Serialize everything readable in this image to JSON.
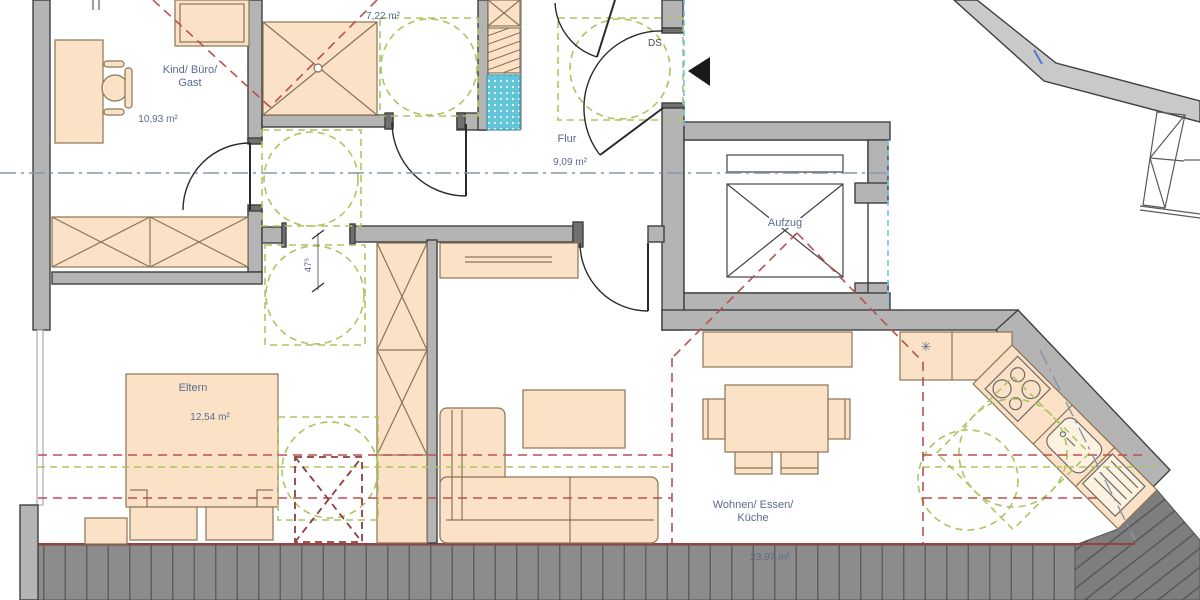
{
  "title": "Apartment floor plan (attic storey)",
  "texts": {
    "kind_line1": "Kind/ Büro/",
    "kind_line2": "Gast",
    "kind_area": "10,93 m²",
    "bath_area": "7,22 m²",
    "flur_name": "Flur",
    "flur_area": "9,09 m²",
    "ds": "DS",
    "aufzug": "Aufzug",
    "eltern_name": "Eltern",
    "eltern_area": "12,54 m²",
    "wohnen_line1": "Wohnen/ Essen/",
    "wohnen_line2": "Küche",
    "wohnen_area": "23,97 m²",
    "door_dim": "47⁵"
  },
  "symbols": {
    "hob": "✳",
    "entrance_arrow": "◀"
  },
  "colors": {
    "wall": "#b4b4b4",
    "wall-dark": "#707070",
    "outline": "#3f3f3f",
    "furn": "#fbe2c6",
    "furn-line": "#8a7456",
    "label": "#5a6b8c",
    "red-dash": "#b8514e",
    "dark-red": "#8d3f3f",
    "green-dash": "#aec462",
    "blue-dash": "#6ec6da",
    "centerline": "#8795ab",
    "decking": "#8c8c8c",
    "tub-blue": "#62c4d8"
  }
}
